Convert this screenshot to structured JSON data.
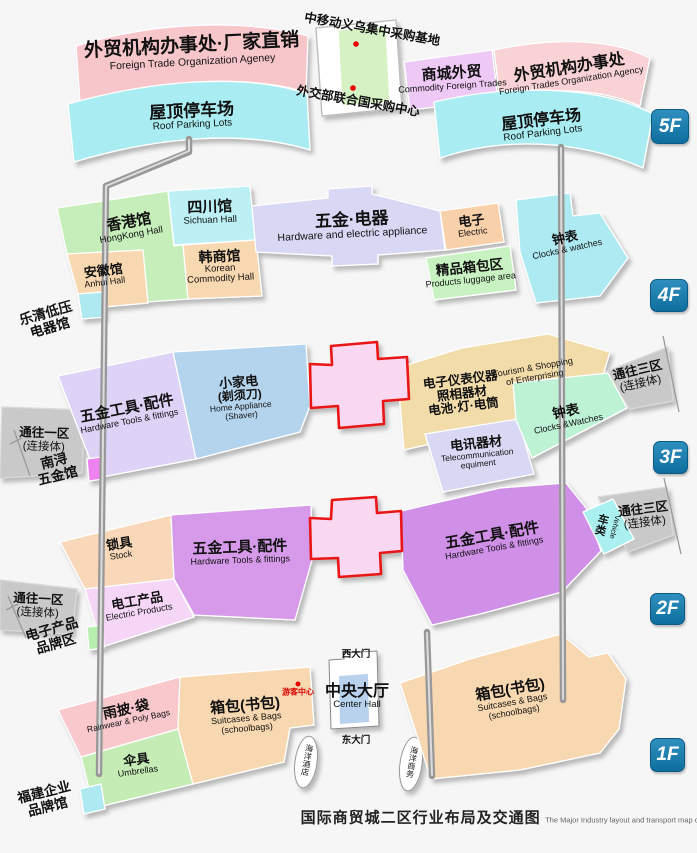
{
  "title": {
    "zh": "国际商贸城二区行业布局及交通图",
    "en": "The Major Industry layout and transport map of International Trade Mart District Two"
  },
  "floor_badges": [
    {
      "label": "5F"
    },
    {
      "label": "4F"
    },
    {
      "label": "3F"
    },
    {
      "label": "2F"
    },
    {
      "label": "1F"
    }
  ],
  "colors": {
    "badge_blue": "#1276a6",
    "atrium_border": "#e91313",
    "visitor_red": "#d80000"
  },
  "regions": {
    "ft_office_factory": {
      "zh": "外贸机构办事处·厂家直销",
      "en": "Foreign Trade Organization Ageney"
    },
    "roof_parking": {
      "zh": "屋顶停车场",
      "en": "Roof Parking Lots"
    },
    "cmcc_base": {
      "zh": "中移动义乌集中采购基地"
    },
    "mofa_un_center": {
      "zh": "外交部联合国采购中心"
    },
    "commodity_foreign_trades": {
      "zh": "商城外贸",
      "en": "Commodity Foreign Trades"
    },
    "ft_office": {
      "zh": "外贸机构办事处",
      "en": "Foreign Trades Organization Agency"
    },
    "hongkong_hall": {
      "zh": "香港馆",
      "en": "HongKong Hall"
    },
    "sichuan_hall": {
      "zh": "四川馆",
      "en": "Sichuan Hall"
    },
    "anhui_hall": {
      "zh": "安徽馆",
      "en": "Anhui Hall"
    },
    "korean_hall": {
      "zh": "韩商馆",
      "en1": "Korean",
      "en2": "Commodity Hall"
    },
    "hardware_electric": {
      "zh": "五金·电器",
      "en": "Hardware and electric appliance"
    },
    "electric": {
      "zh": "电子",
      "en": "Electric"
    },
    "luggage_area": {
      "zh": "精品箱包区",
      "en": "Products luggage area"
    },
    "clocks_4f": {
      "zh": "钟表",
      "en": "Clocks & watches"
    },
    "yueqing_hall": {
      "line1": "乐清低压",
      "line2": "电器馆"
    },
    "ramp_district1": {
      "zh": "通往一区",
      "sub": "(连接体)"
    },
    "ramp_district3": {
      "zh": "通往三区",
      "sub": "(连接体)"
    },
    "hardware_tools": {
      "zh": "五金工具·配件",
      "en": "Hardware Tools & fittings"
    },
    "home_appliance": {
      "zh1": "小家电",
      "zh2": "(剃须刀)",
      "en1": "Home Appliance",
      "en2": "(Shaver)"
    },
    "instruments": {
      "line1": "电子仪表仪器",
      "line2": "照相器材",
      "line3": "电池·灯·电筒"
    },
    "tourism_shopping": {
      "en1": "Tourism & Shopping",
      "en2": "of Enterprising"
    },
    "telecom": {
      "zh": "电讯器材",
      "en1": "Telecommunication",
      "en2": "equiment"
    },
    "clocks_3f": {
      "zh": "钟表",
      "en": "Clocks &Watches"
    },
    "nanxun_hall": {
      "line1": "南浔",
      "line2": "五金馆"
    },
    "locks": {
      "zh": "锁具",
      "en": "Stock"
    },
    "electric_products": {
      "zh": "电工产品",
      "en": "Electric Products"
    },
    "vehicle": {
      "zh": "车类",
      "en": "Vehicle"
    },
    "e_products_brand": {
      "line1": "电子产品",
      "line2": "品牌区"
    },
    "rainwear": {
      "zh": "雨披·袋",
      "en": "Rainwear & Poly Bags"
    },
    "umbrellas": {
      "zh": "伞具",
      "en": "Umbrellas"
    },
    "suitcases": {
      "zh": "箱包(书包)",
      "en1": "Suitcases & Bags",
      "en2": "(schoolbags)"
    },
    "visitor_center": {
      "zh": "游客中心"
    },
    "west_gate": {
      "zh": "西大门"
    },
    "east_gate": {
      "zh": "东大门"
    },
    "center_hall": {
      "zh": "中央大厅",
      "en": "Center Hall"
    },
    "ocean_hotel": {
      "zh": "海洋酒店"
    },
    "ocean_business": {
      "zh": "海洋商务"
    },
    "fujian_brand_hall": {
      "line1": "福建企业",
      "line2": "品牌馆"
    }
  }
}
